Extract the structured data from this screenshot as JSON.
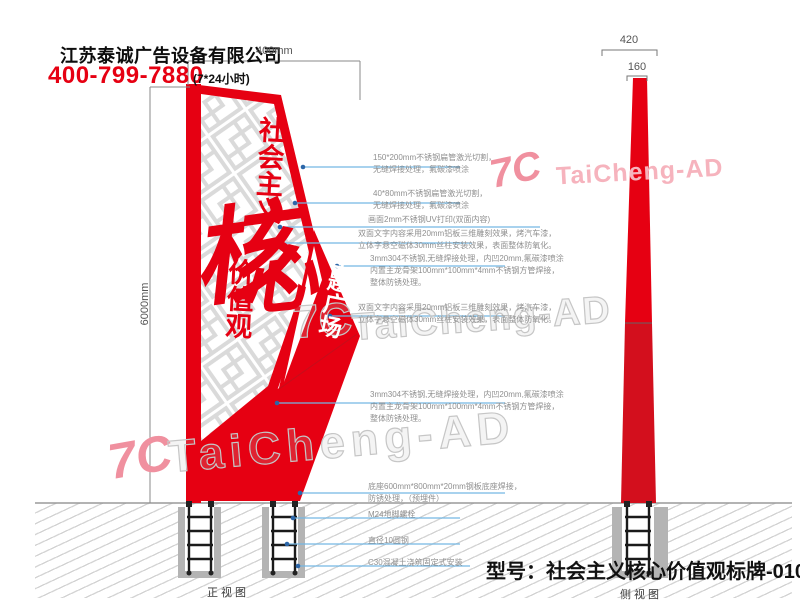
{
  "header": {
    "company": "江苏泰诚广告设备有限公司",
    "phone": "400-799-7880",
    "hours": "(7*24小时)"
  },
  "dimensions": {
    "front_width": "400mm",
    "front_height": "6000mm",
    "side_bottom_width": "420",
    "side_top_width": "160"
  },
  "sign": {
    "slogan_top": "社会主义",
    "core_char_1": "核",
    "core_char_2": "心",
    "slogan_bottom": "价值观",
    "plaza": "主题广场"
  },
  "annotations": [
    {
      "lines": [
        "150*200mm不锈钢扁管激光切割，",
        "无缝焊接处理，氟碳漆喷涂"
      ]
    },
    {
      "lines": [
        "40*80mm不锈钢扁管激光切割，",
        "无缝焊接处理，氟碳漆喷涂"
      ]
    },
    {
      "lines": [
        "画面2mm不锈钢UV打印(双面内容)"
      ]
    },
    {
      "lines": [
        "双面文字内容采用20mm铝板三维雕刻效果，烤汽车漆，",
        "立体字悬空磁体30mm丝柱安装效果，表面整体防氧化。"
      ]
    },
    {
      "lines": [
        "3mm304不锈钢,无缝焊接处理，内凹20mm,氟碳漆喷涂",
        "内置主龙骨架100mm*100mm*4mm不锈钢方管焊接，",
        "整体防锈处理。"
      ]
    },
    {
      "lines": [
        "双面文字内容采用20mm铝板三维雕刻效果，烤汽车漆，",
        "立体字悬空磁体30mm丝柱安装效果，表面整体防氧化。"
      ]
    },
    {
      "lines": [
        "3mm304不锈钢,无缝焊接处理，内凹20mm,氟碳漆喷涂",
        "内置主龙骨架100mm*100mm*4mm不锈钢方管焊接，",
        "整体防锈处理。"
      ]
    },
    {
      "lines": [
        "底座600mm*800mm*20mm钢板底座焊接，",
        "防锈处理，（预埋件）"
      ]
    },
    {
      "lines": [
        "M24地脚螺栓"
      ]
    },
    {
      "lines": [
        "直径10圆钢"
      ]
    },
    {
      "lines": [
        "C30混凝土浇筑固定式安装"
      ]
    }
  ],
  "watermark": {
    "logo": "7C",
    "text": "TaiCheng-AD"
  },
  "footer": {
    "model": "型号：社会主义核心价值观标牌-0101",
    "front_view_label": "正视图",
    "side_view_label": "侧视图"
  },
  "colors": {
    "red": "#e60012",
    "red_dark": "#d30f1d",
    "leader_blue": "#74b7e3",
    "dot_blue": "#2c66a8",
    "annotation_gray": "#8f8f8f",
    "lattice_gray": "#dadada",
    "concrete_gray": "#b4b4b4"
  }
}
